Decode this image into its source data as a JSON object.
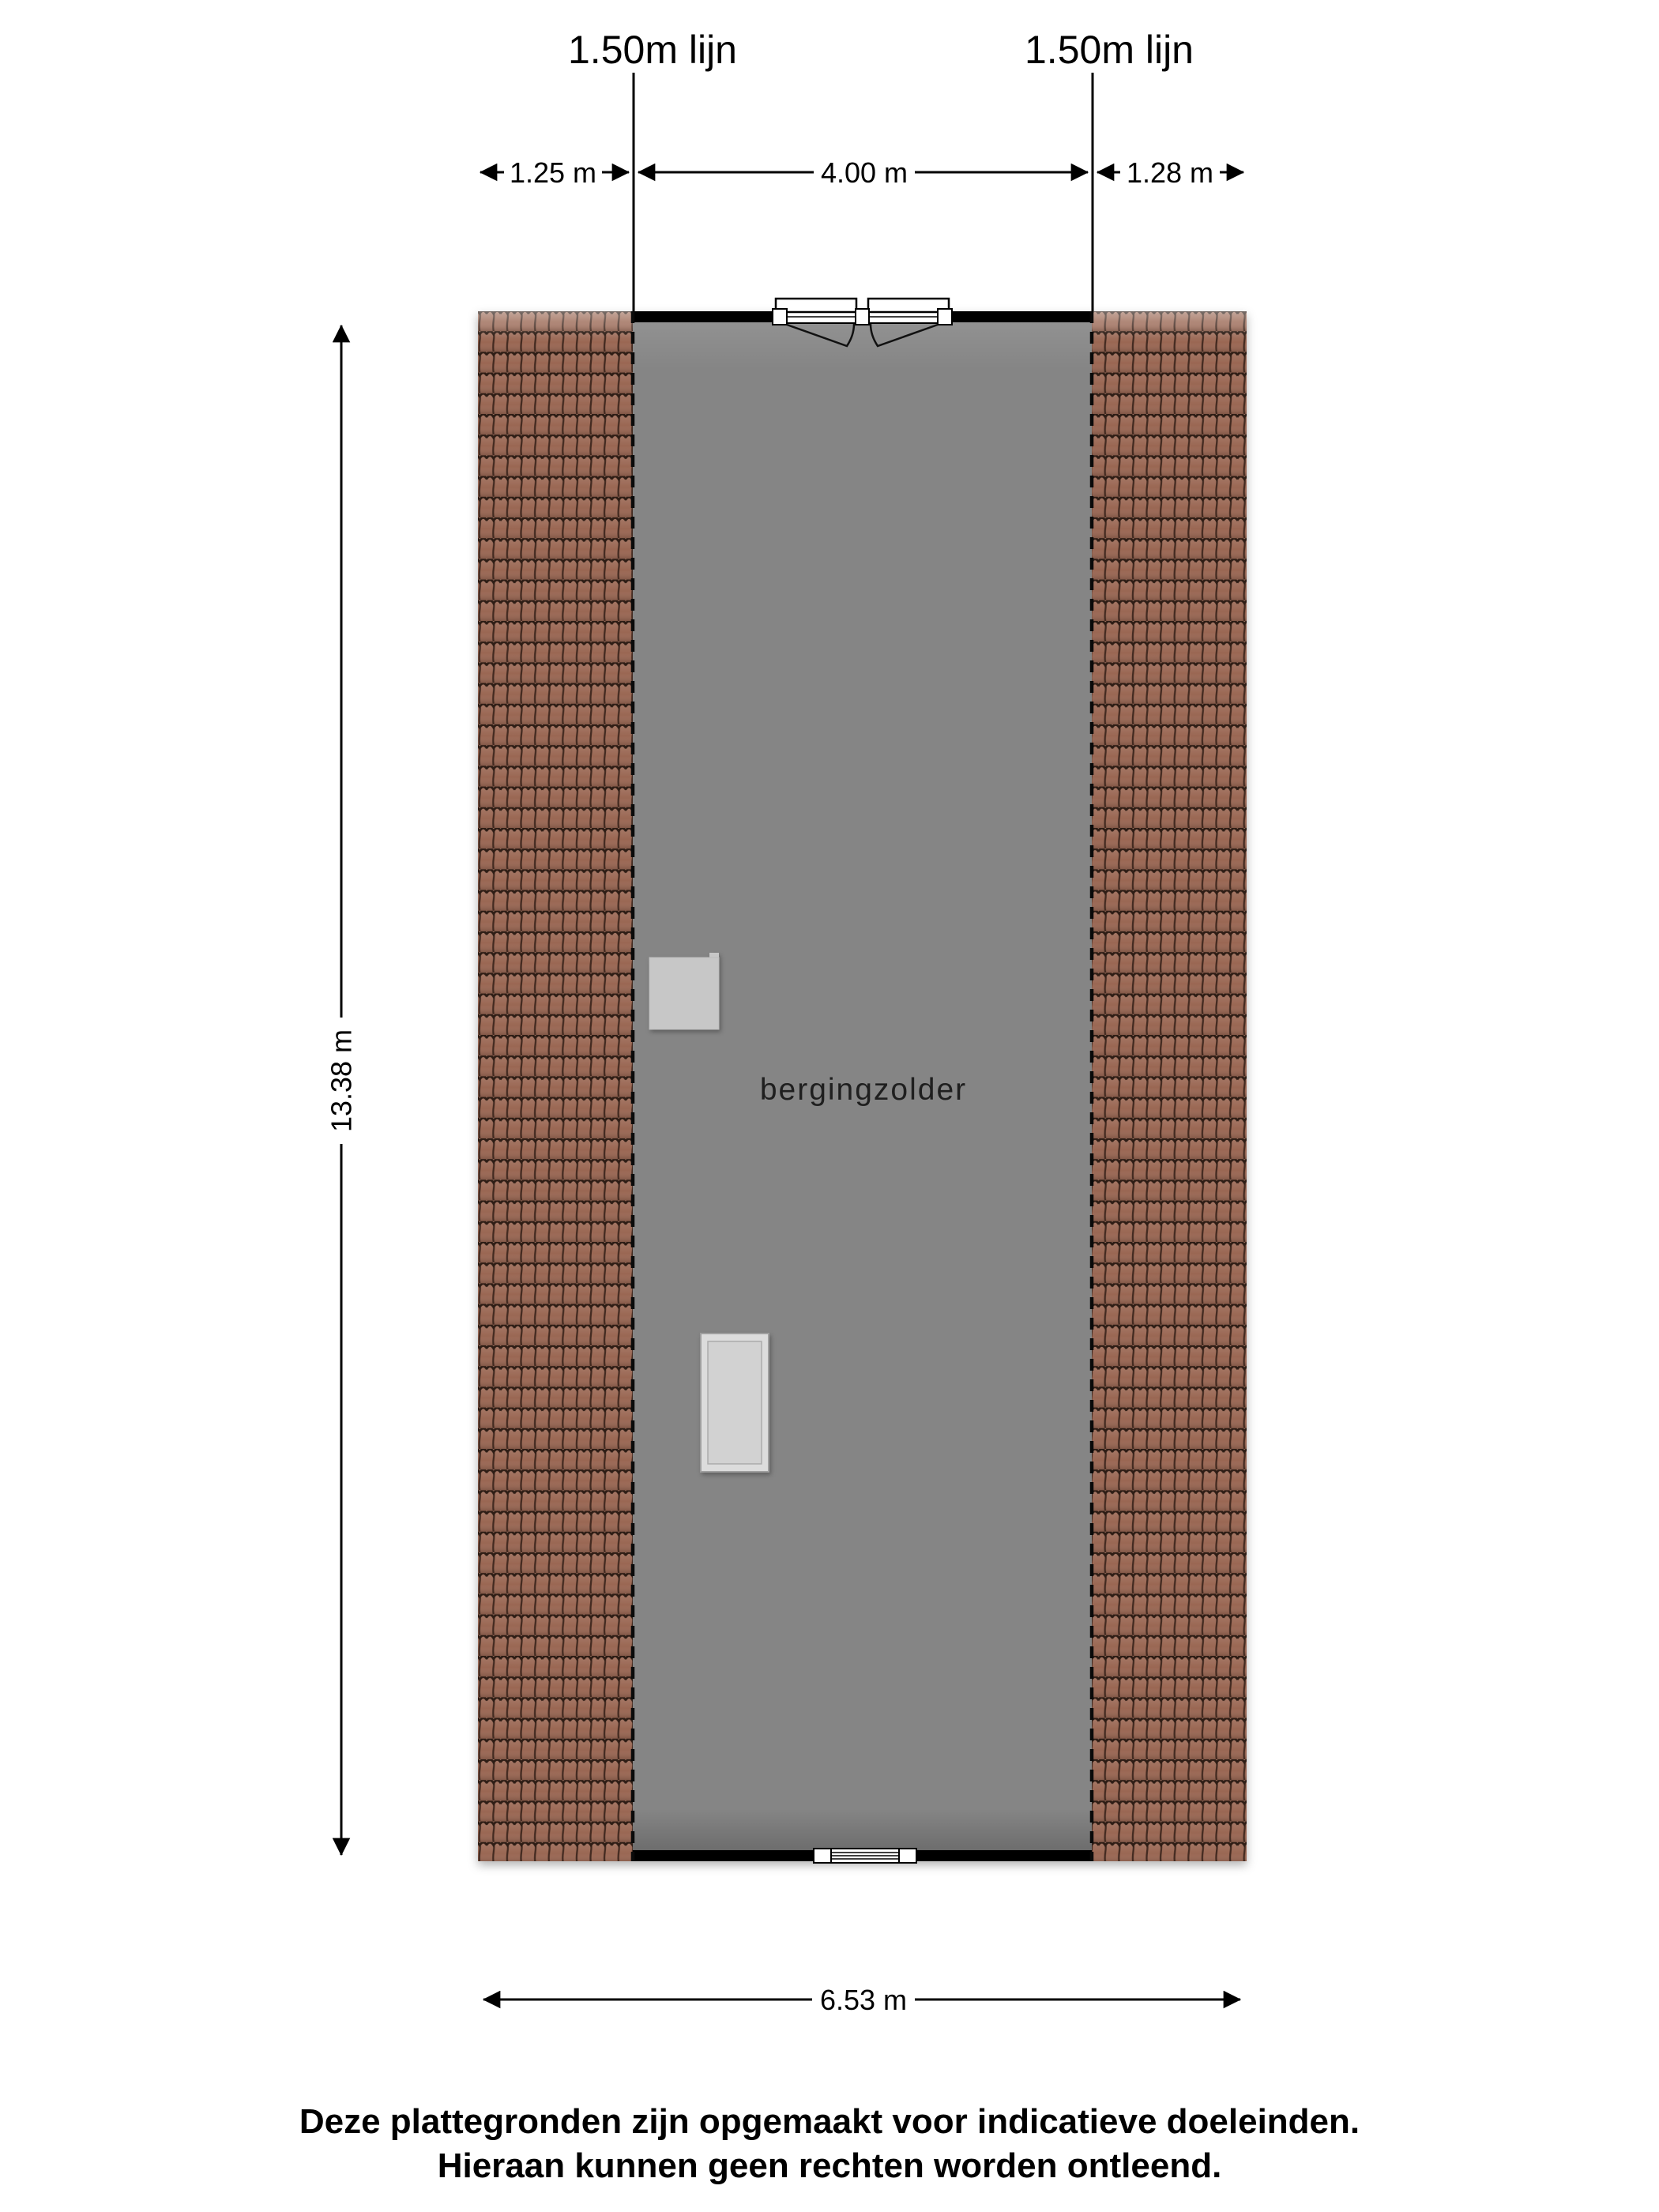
{
  "plan": {
    "room_label": "bergingzolder",
    "height_lines": {
      "left_label": "1.50m lijn",
      "right_label": "1.50m lijn"
    },
    "dimensions": {
      "top_left": "1.25 m",
      "top_middle": "4.00 m",
      "top_right": "1.28 m",
      "side": "13.38 m",
      "bottom": "6.53 m"
    },
    "colors": {
      "wall": "#000000",
      "floor": "#858585",
      "roof_tile": "#9a6753",
      "roof_groove": "#2e1d15",
      "skylight": "#c7c7c7",
      "hatch": "#dcdcdc",
      "dimension_line": "#000000"
    }
  },
  "footer": {
    "line1": "Deze plattegronden zijn opgemaakt voor indicatieve doeleinden.",
    "line2": "Hieraan kunnen geen rechten worden ontleend."
  }
}
